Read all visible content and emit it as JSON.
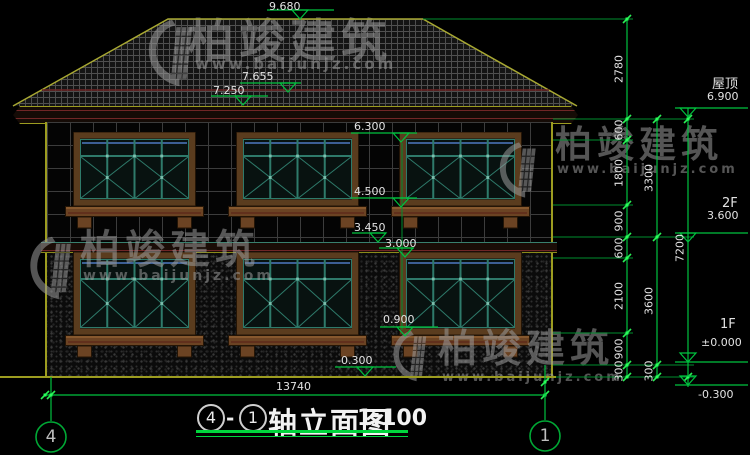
{
  "watermark": {
    "brand": "柏竣建筑",
    "url": "www.baijunjz.com"
  },
  "title": {
    "axis_start": "4",
    "separator": "-",
    "axis_end": "1",
    "name": "轴立面图",
    "scale": "1:100"
  },
  "axis_bubbles": {
    "left": "4",
    "right": "1"
  },
  "levels_left": [
    "9.680",
    "7.655",
    "7.250",
    "6.300",
    "4.500",
    "3.450",
    "3.000",
    "0.900",
    "-0.300"
  ],
  "levels_right": [
    {
      "label": "屋顶",
      "value": "6.900"
    },
    {
      "label": "2F",
      "value": "3.600"
    },
    {
      "label": "1F",
      "value": "±0.000"
    },
    {
      "label": "",
      "value": "-0.300"
    }
  ],
  "dimensions": {
    "col_inner": [
      "2780",
      "600",
      "1800",
      "900",
      "600",
      "2100",
      "900",
      "300"
    ],
    "col_mid": [
      "3300",
      "3600",
      "300"
    ],
    "col_outer": [
      "7200"
    ],
    "bottom": [
      "13740"
    ]
  },
  "colors": {
    "dim_green": "#00c23f",
    "tick_green": "#2bee55",
    "outline_olive": "#a8a832",
    "frame_brown": "#5a3c1e",
    "sash_teal": "#2e7a6a",
    "accent_maroon": "#6e2626",
    "watermark_gray": "#9b9b9b"
  }
}
